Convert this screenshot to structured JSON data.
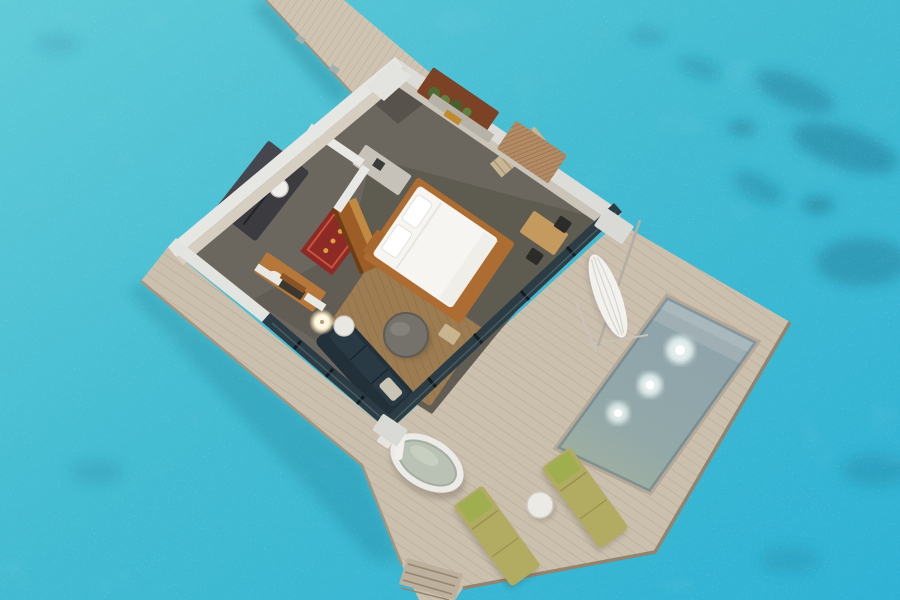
{
  "scene": {
    "description_elements": {
      "ocean": "turquoise lagoon water with ripple speckle and dark coral patches",
      "jetty": "wooden boardwalk entering from top-left to villa entrance",
      "villa": "cutaway overwater villa floor plan",
      "rooms": [
        "entry",
        "bathroom",
        "shower",
        "vanity",
        "bedroom",
        "living-room",
        "closet"
      ],
      "deck": "L-shaped wooden sun deck wrapping east and south sides",
      "pool": "rectangular plunge pool with underwater lights",
      "outdoor": [
        "freestanding-bathtub",
        "outdoor-shower-column",
        "two-sun-loungers",
        "round-side-table",
        "closed-umbrella",
        "water-steps"
      ]
    },
    "counts": {
      "pool_lights": 3,
      "sun_loungers": 2,
      "lounger_pillows": 2,
      "desk_chairs": 2,
      "bed_pillows": 2,
      "glass_mullions_se": 5,
      "glass_mullions_sw": 3,
      "step_treads": 4,
      "niche_plants": 4
    }
  },
  "colors": {
    "water_light": "#5fc9d7",
    "water_deep": "#2fb2d4",
    "coral_dark": "#1e7a97",
    "deck_wood": "#cbbfae",
    "deck_edge": "#93846f",
    "jetty_wood": "#cfc3b2",
    "wall_white": "#e3e3df",
    "wall_inner": "#cdc7bb",
    "glass_dark": "#2c3c44",
    "floor_gray": "#6b675f",
    "carpet_bedroom": "#5e5b51",
    "rug_wood": "#9d7c52",
    "rug_red": "#8e2a26",
    "wood_brown": "#a4682e",
    "bed_white": "#f6f5f1",
    "sofa_dark": "#223039",
    "pool_tile_near": "#8da2ac",
    "pool_tile_far": "#9fb2a0",
    "lounger_olive": "#b2ac63",
    "lounger_pillow": "#9fae4e",
    "tub_rim": "#ecebe7",
    "tub_basin": "#b9c2b4",
    "umbrella_white": "#f2f1ed",
    "lamp_glow": "#f7ecd2"
  }
}
